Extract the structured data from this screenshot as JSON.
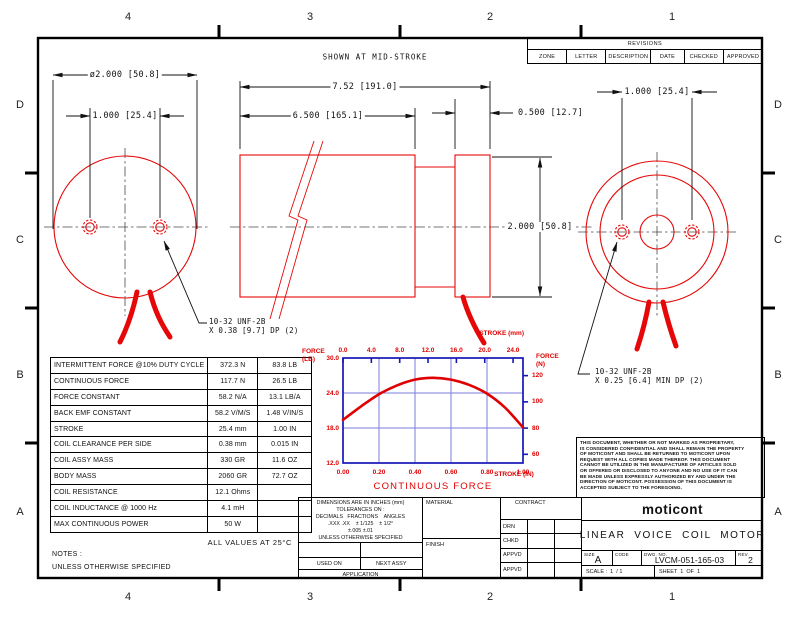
{
  "sheet": {
    "zones_top": [
      "4",
      "3",
      "2",
      "1"
    ],
    "zones_bottom": [
      "4",
      "3",
      "2",
      "1"
    ],
    "zones_left": [
      "D",
      "C",
      "B",
      "A"
    ],
    "zones_right": [
      "D",
      "C",
      "B",
      "A"
    ]
  },
  "revisions": {
    "title": "REVISIONS",
    "columns": [
      "ZONE",
      "LETTER",
      "DESCRIPTION",
      "DATE",
      "CHECKED",
      "APPROVED"
    ]
  },
  "annotations": {
    "mid_stroke": "SHOWN AT MID-STROKE",
    "thread_left_line1": "10-32 UNF-2B",
    "thread_left_line2": "X 0.38 [9.7] DP (2)",
    "thread_right_line1": "10-32 UNF-2B",
    "thread_right_line2": "X 0.25 [6.4] MIN DP (2)",
    "notes_label": "NOTES :",
    "notes_line": "UNLESS OTHERWISE SPECIFIED",
    "all_values": "ALL VALUES AT 25°C"
  },
  "dimensions": {
    "left_diameter": "ø2.000 [50.8]",
    "left_hole_spacing": "1.000 [25.4]",
    "overall_length": "7.52 [191.0]",
    "body_length": "6.500 [165.1]",
    "cap_length": "0.500 [12.7]",
    "body_diameter": "2.000 [50.8]",
    "right_hole_spacing": "1.000 [25.4]"
  },
  "spec_table": {
    "rows": [
      {
        "label": "INTERMITTENT FORCE @10% DUTY CYCLE",
        "metric": "372.3 N",
        "imperial": "83.8 LB"
      },
      {
        "label": "CONTINUOUS FORCE",
        "metric": "117.7 N",
        "imperial": "26.5 LB"
      },
      {
        "label": "FORCE CONSTANT",
        "metric": "58.2 N/A",
        "imperial": "13.1 LB/A"
      },
      {
        "label": "BACK EMF CONSTANT",
        "metric": "58.2 V/M/S",
        "imperial": "1.48 V/IN/S"
      },
      {
        "label": "STROKE",
        "metric": "25.4 mm",
        "imperial": "1.00 IN"
      },
      {
        "label": "COIL CLEARANCE PER SIDE",
        "metric": "0.38 mm",
        "imperial": "0.015 IN"
      },
      {
        "label": "COIL ASSY MASS",
        "metric": "330 GR",
        "imperial": "11.6 OZ"
      },
      {
        "label": "BODY MASS",
        "metric": "2060 GR",
        "imperial": "72.7 OZ"
      },
      {
        "label": "COIL RESISTANCE",
        "metric": "12.1 Ohms",
        "imperial": ""
      },
      {
        "label": "COIL INDUCTANCE @ 1000 Hz",
        "metric": "4.1 mH",
        "imperial": ""
      },
      {
        "label": "MAX CONTINUOUS POWER",
        "metric": "50 W",
        "imperial": ""
      }
    ]
  },
  "tolerance_block": {
    "line1": "DIMENSIONS ARE IN INCHES (mm)",
    "line2": "TOLERANCES ON :",
    "line3": "DECIMALS   FRACTIONS    ANGLES",
    "line4": ".XXX .XX    ± 1/125    ± 1/2°",
    "line5": "±.005 ±.01",
    "line6": "UNLESS OTHERWISE SPECIFIED",
    "used_on": "USED ON",
    "next_assy": "NEXT ASSY",
    "application": "APPLICATION"
  },
  "material_label": "MATERIAL",
  "finish_label": "FINISH",
  "contract_label": "CONTRACT",
  "sign_rows": [
    "DRN",
    "CHKD",
    "APPVD",
    "APPVD"
  ],
  "title_block": {
    "logo": "moticont",
    "title": "LINEAR  VOICE  COIL  MOTOR",
    "size_label": "SIZE",
    "size_value": "A",
    "code_label": "CODE",
    "dwg_label": "DWG. NO.",
    "dwg_number": "LVCM-051-165-03",
    "rev_label": "REV.",
    "rev_value": "2",
    "scale_text": "SCALE :  1  / 1",
    "sheet_text": "SHEET  1  OF  1"
  },
  "proprietary_note_lines": [
    "THIS DOCUMENT, WHETHER OR NOT MARKED AS PROPRIETARY,",
    "IS CONSIDERED CONFIDENTIAL AND SHALL REMAIN THE PROPERTY",
    "OF MOTICONT AND SHALL BE RETURNED TO MOTICONT UPON",
    "REQUEST WITH ALL COPIES MADE THEREOF. THIS DOCUMENT",
    "CANNOT BE UTILIZED IN THE MANUFACTURE OF ARTICLES SOLD",
    "OR OFFERED OR DISCLOSED TO ANYONE AND NO USE OF IT CAN",
    "BE MADE UNLESS EXPRESSLY AUTHORIZED BY AND UNDER THE",
    "DIRECTION OF MOTICONT. POSSESSION OF THIS DOCUMENT IS",
    "ACCEPTED SUBJECT TO THE FOREGOING."
  ],
  "chart_data": {
    "type": "line",
    "title": "CONTINUOUS FORCE",
    "axes": {
      "top": {
        "label": "STROKE (mm)",
        "ticks": [
          "0.0",
          "4.0",
          "8.0",
          "12.0",
          "16.0",
          "20.0",
          "24.0"
        ],
        "range": [
          0,
          24
        ]
      },
      "bottom": {
        "label": "STROKE (IN)",
        "ticks": [
          "0.00",
          "0.20",
          "0.40",
          "0.60",
          "0.80",
          "1.00"
        ],
        "range": [
          0,
          1
        ]
      },
      "left": {
        "label": "FORCE (LB)",
        "ticks": [
          "30.0",
          "24.0",
          "18.0",
          "12.0"
        ],
        "range": [
          12,
          30
        ]
      },
      "right": {
        "label": "FORCE (N)",
        "ticks": [
          "120",
          "100",
          "80",
          "60"
        ],
        "range": [
          53.4,
          133.4
        ]
      }
    },
    "grid": true,
    "legend": "none",
    "series": [
      {
        "name": "CONTINUOUS FORCE",
        "x_stroke_in": [
          0,
          0.1,
          0.2,
          0.3,
          0.4,
          0.5,
          0.6,
          0.7,
          0.8,
          0.9,
          1.0
        ],
        "y_force_lb": [
          19.4,
          21.7,
          23.8,
          25.3,
          26.3,
          26.6,
          26.3,
          25.4,
          23.9,
          21.5,
          18.1
        ]
      }
    ],
    "colors": {
      "curve": "#e00000",
      "grid": "#7d7ddd",
      "border": "#1616b6",
      "text": "#e00000"
    }
  }
}
